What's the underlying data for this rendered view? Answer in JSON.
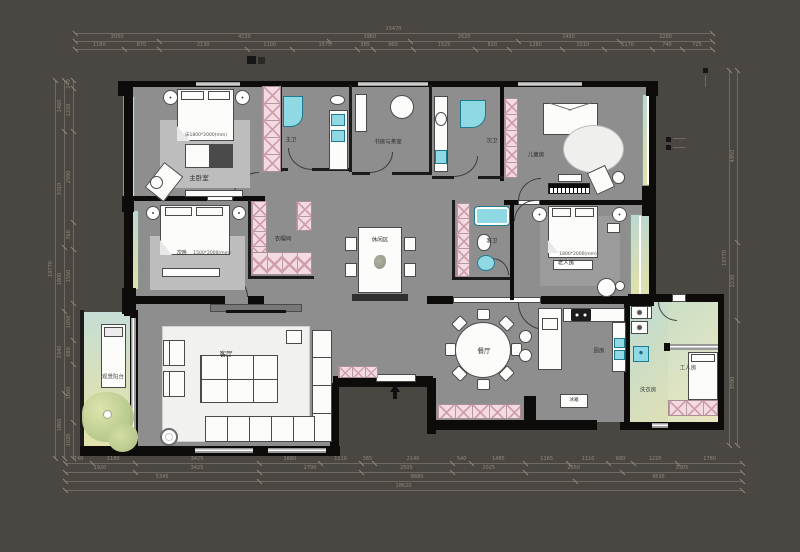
{
  "labels": {
    "master_bedroom": "主卧室",
    "master_bath": "主卫",
    "study_tea": "书房与茶室",
    "guest_bath_top": "次卫",
    "kids_room": "儿童房",
    "bedroom2": "次卧",
    "closet": "衣帽间",
    "leisure": "休闲区",
    "guest_bath_mid": "客卫",
    "elder_room": "老人房",
    "living_room": "客厅",
    "balcony": "观景阳台",
    "dining_room": "餐厅",
    "kitchen": "厨房",
    "fridge": "冰箱",
    "laundry": "洗衣房",
    "maid_room": "工人房"
  },
  "annotations": {
    "master_bed_size": "床1800*2000(mm)",
    "bedroom2_size": "1500*2000(mm)",
    "elder_bed_size": "1800*2000(mm)"
  },
  "colors": {
    "background": "#4a4742",
    "floor": "#8e8e8e",
    "wall": "#0d0c0a",
    "wardrobe_pink": "#f4dae1",
    "fixture_teal": "#8ed9e4",
    "balcony_green": "#d8ddb2"
  },
  "dimensions": {
    "chains": [
      {
        "o": "h",
        "y": 33,
        "x1": 75,
        "x2": 712,
        "segs": [
          "15470"
        ]
      },
      {
        "o": "h",
        "y": 41,
        "x1": 75,
        "x2": 712,
        "segs": [
          "2050",
          "4130",
          "1960",
          "2620",
          "2450",
          "2260"
        ]
      },
      {
        "o": "h",
        "y": 49,
        "x1": 75,
        "x2": 712,
        "segs": [
          "1180",
          "870",
          "2130",
          "1100",
          "1575",
          "385",
          "960",
          "1525",
          "820",
          "1280",
          "1010",
          "1170",
          "740",
          "725"
        ]
      },
      {
        "o": "h",
        "y": 463,
        "x1": 65,
        "x2": 742,
        "segs": [
          "740",
          "1180",
          "3425",
          "1680",
          "1110",
          "365",
          "2140",
          "540",
          "1485",
          "1165",
          "1110",
          "680",
          "1220",
          "1780"
        ]
      },
      {
        "o": "h",
        "y": 472,
        "x1": 65,
        "x2": 742,
        "segs": [
          "1920",
          "3425",
          "2790",
          "2505",
          "2025",
          "2650",
          "3305"
        ]
      },
      {
        "o": "h",
        "y": 481,
        "x1": 65,
        "x2": 742,
        "segs": [
          "5345",
          "8680",
          "4595"
        ]
      },
      {
        "o": "h",
        "y": 490,
        "x1": 65,
        "x2": 742,
        "segs": [
          "18620"
        ]
      },
      {
        "o": "v",
        "x": 55,
        "y1": 80,
        "y2": 458,
        "segs": [
          "10770"
        ]
      },
      {
        "o": "v",
        "x": 64,
        "y1": 80,
        "y2": 458,
        "segs": [
          "1460",
          "3310",
          "1800",
          "2340",
          "1860"
        ]
      },
      {
        "o": "v",
        "x": 73,
        "y1": 80,
        "y2": 458,
        "segs": [
          "240",
          "1220",
          "2590",
          "760",
          "1550",
          "1050",
          "680",
          "1660",
          "1020"
        ]
      },
      {
        "o": "v",
        "x": 737,
        "y1": 70,
        "y2": 445,
        "segs": [
          "4950",
          "2230",
          "3590"
        ]
      },
      {
        "o": "v",
        "x": 729,
        "y1": 70,
        "y2": 445,
        "segs": [
          "10770"
        ]
      }
    ]
  }
}
